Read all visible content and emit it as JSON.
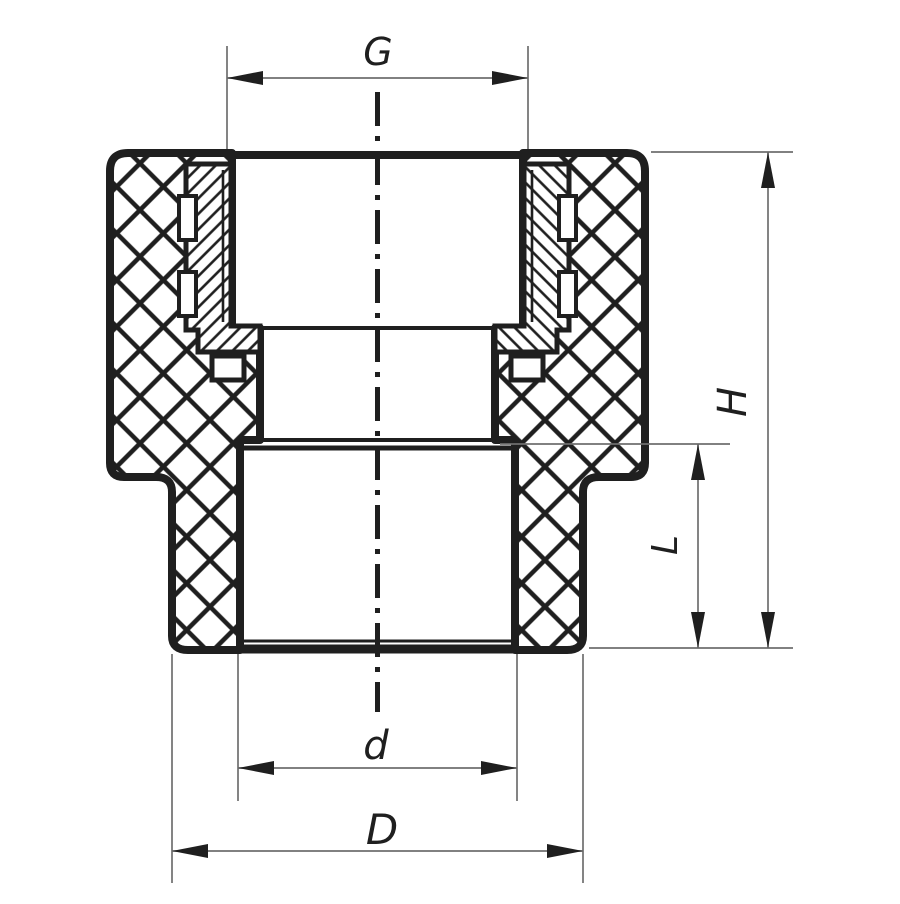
{
  "drawing": {
    "labels": {
      "thread_size": "G",
      "total_height": "H",
      "socket_depth": "L",
      "socket_inner_diameter": "d",
      "body_outer_diameter": "D"
    },
    "colors": {
      "line": "#1f1f1f",
      "dimension": "#6f6f6f",
      "background": "#ffffff"
    }
  }
}
